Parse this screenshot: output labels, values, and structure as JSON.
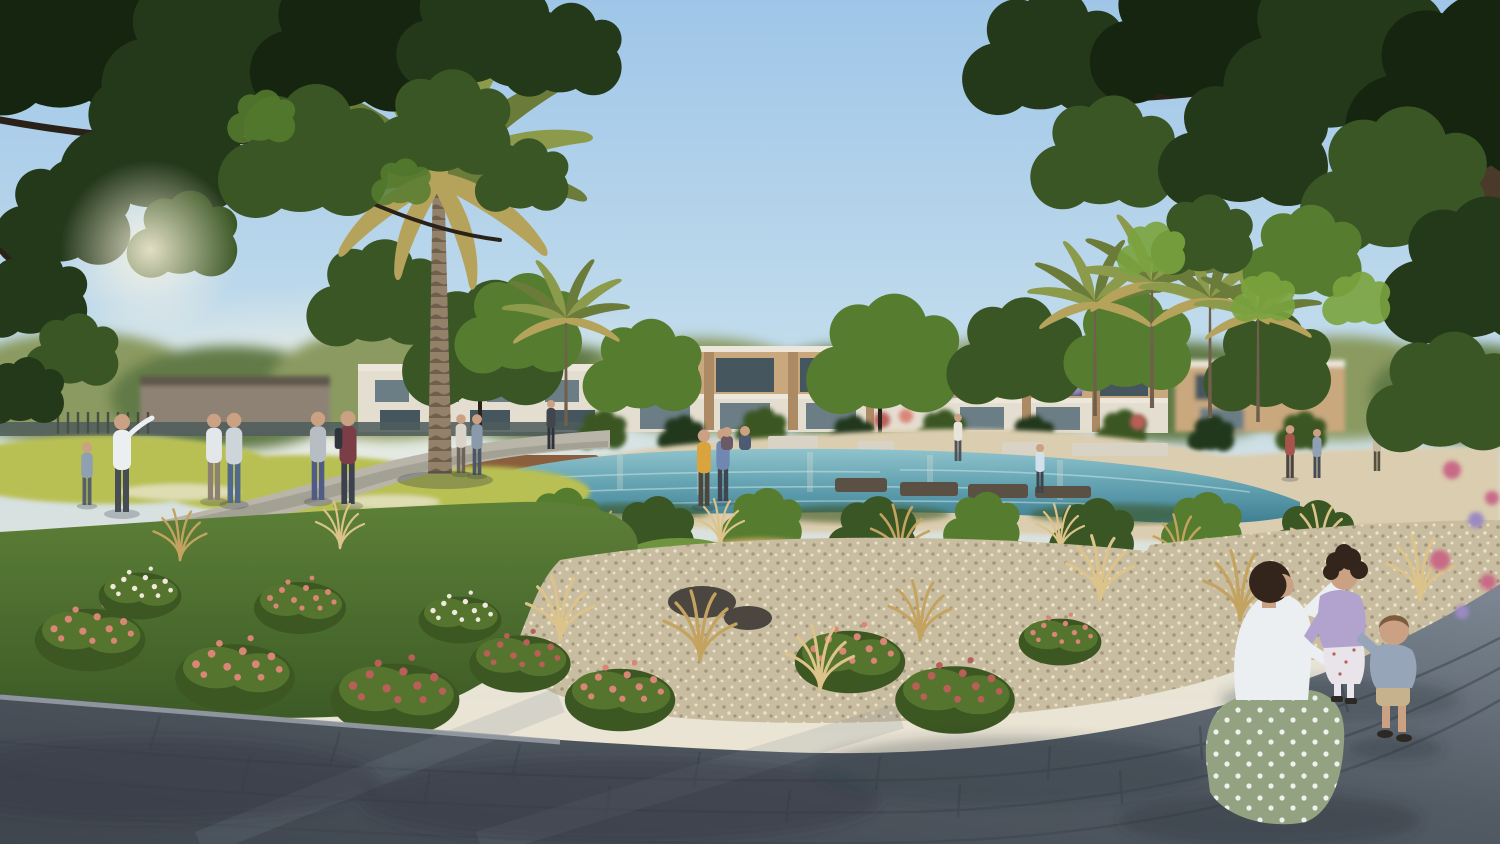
{
  "meta": {
    "title": "Residential community park with lake - architectural rendering",
    "image_type": "photorealistic architectural rendering, no text or UI elements",
    "dimensions": {
      "width": 1500,
      "height": 844
    }
  },
  "scene": {
    "elements": [
      "sky",
      "overhanging-tree-canopy-left",
      "overhanging-tree-canopy-right",
      "distant-treeline",
      "background-villas",
      "date-palm",
      "mini-palms",
      "lake-stream",
      "sand-bank",
      "stepping-stones",
      "seat-blocks",
      "timber-deck",
      "yellow-flower-bed",
      "flower-bushes",
      "ornamental-grasses",
      "gravel-garden",
      "lawn",
      "walking-paths",
      "stone-plaza",
      "park-visitors",
      "mother-with-two-children"
    ],
    "people": {
      "background_figures": 18,
      "foreground_family": [
        "mother kneeling in white shirt and green polka-dot skirt",
        "girl in lilac cardigan and white floral dress",
        "toddler in blue-grey sweater and khaki shorts"
      ]
    },
    "colors": {
      "sky_top": "#9fc6e8",
      "sky_mid": "#c2dcec",
      "sky_low": "#e4e4d9",
      "sky_horizon": "#f0e4cf",
      "canopy_darkest": "#16250f",
      "canopy_dark": "#24381a",
      "canopy_mid": "#3a5624",
      "canopy_light": "#567d2f",
      "canopy_sunlit": "#7ba43f",
      "canopy_gold": "#9aa94e",
      "treeline": "#8a9a60",
      "treeline_dark": "#627a46",
      "branch_dark": "#2a2118",
      "trunk_brown": "#4a3a2a",
      "palm_trunk": "#93816a",
      "palm_trunk_dark": "#6f5f4c",
      "palm_frond": "#6b7c3a",
      "palm_frond_light": "#8c9a4c",
      "palm_frond_gold": "#b5a35c",
      "house_parapet": "#ece7da",
      "house_beige": "#c9a87e",
      "house_beige_dark": "#ac8b64",
      "house_light": "#e4ded0",
      "house_glass": "#46565e",
      "house_glass_light": "#6b7d85",
      "wall_dark": "#4e5c5c",
      "field_yellow": "#b9c053",
      "shrub_green": "#55752f",
      "shrub_dark": "#3c5722",
      "shrub_light": "#6f9440",
      "golden_grass": "#c3a35f",
      "golden_light": "#dcc389",
      "sand": "#dbcdaf",
      "gravel": "#c9bda1",
      "gravel_dot_dark": "#a2957a",
      "gravel_dot_light": "#ece2c8",
      "water_light": "#8fc3cc",
      "water_mid": "#62a1b0",
      "water_deep": "#3f7f93",
      "deck_brown": "#8a5f3e",
      "stone_step": "#5b5044",
      "path_light": "#b9b5a9",
      "path_shadow": "#8e8b80",
      "grass_green": "#5d8038",
      "grass_dark": "#3c5b26",
      "flower_pink": "#d98677",
      "flower_pink_dark": "#b85f58",
      "flower_white": "#efe9dc",
      "flower_magenta": "#c86a86",
      "lilac_bloom": "#9b8ac2",
      "pavement": "#525a63",
      "pavement_dark": "#3e454d",
      "pavement_light": "#7d8894",
      "curb": "#9aa1a8",
      "shadow": "#2c3440",
      "rock": "#4b463f",
      "skin": "#caa183",
      "hair_dark": "#33251c",
      "hair_brown": "#7c5b3e",
      "shirt_white": "#eceff1",
      "skirt_green": "#93a382",
      "cardigan_lilac": "#b2a3ce",
      "dress_white": "#e8e4ea",
      "sweater_blue": "#97a5b8",
      "shorts_khaki": "#c6b28c",
      "shoe_dark": "#2c2824"
    }
  }
}
